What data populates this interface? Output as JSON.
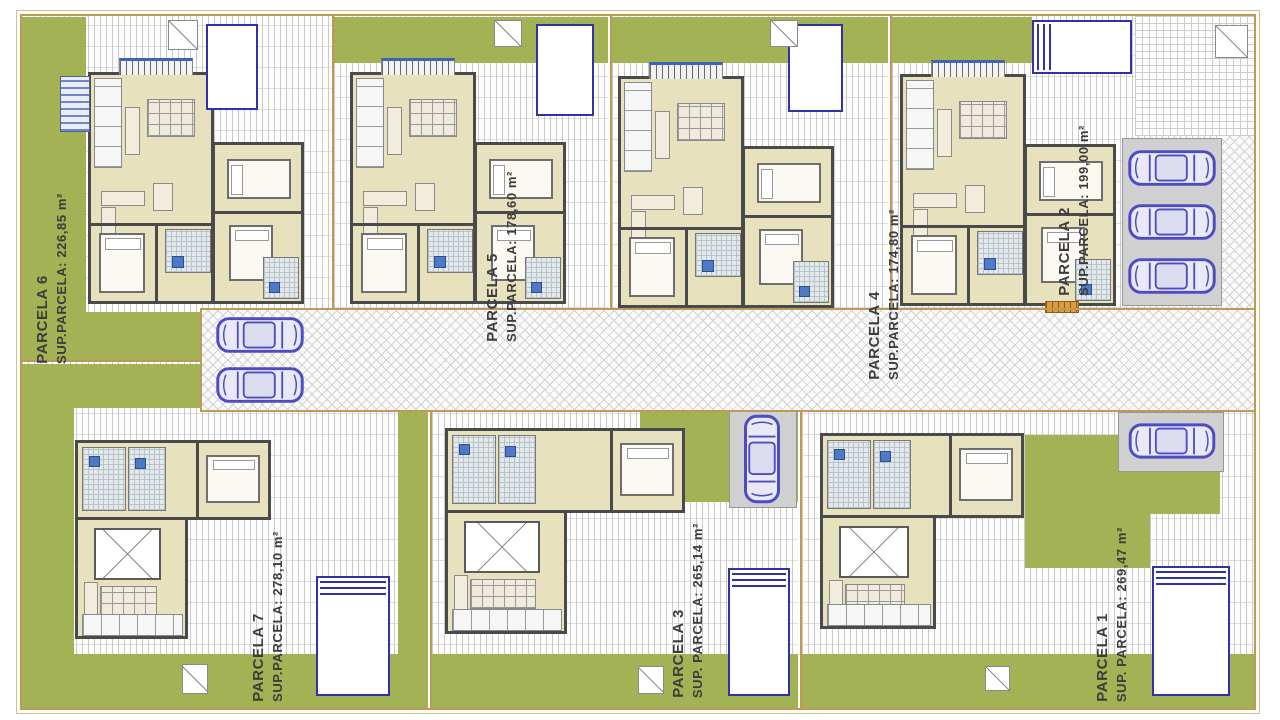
{
  "parcels": [
    {
      "id": "parcela-6",
      "name": "PARCELA 6",
      "area_label": "SUP.PARCELA: 226,85 m²"
    },
    {
      "id": "parcela-5",
      "name": "PARCELA 5",
      "area_label": "SUP.PARCELA: 178,60 m²"
    },
    {
      "id": "parcela-4",
      "name": "PARCELA 4",
      "area_label": "SUP.PARCELA: 174,80 m²"
    },
    {
      "id": "parcela-2",
      "name": "PARCELA 2",
      "area_label": "SUP.PARCELA: 199,00 m²"
    },
    {
      "id": "parcela-7",
      "name": "PARCELA 7",
      "area_label": "SUP.PARCELA: 278,10 m²"
    },
    {
      "id": "parcela-3",
      "name": "PARCELA 3",
      "area_label": "SUP. PARCELA: 265,14 m²"
    },
    {
      "id": "parcela-1",
      "name": "PARCELA 1",
      "area_label": "SUP. PARCELA: 269,47 m²"
    }
  ],
  "colors": {
    "garden_green": "#a2b255",
    "interior_beige": "#e8e1bd",
    "wall_gray": "#4a4a4a",
    "boundary_tan": "#bd9a55",
    "pool_blue": "#3232a8",
    "car_blue": "#4d4dc2",
    "parking_pad_gray": "#d0d0d0",
    "bench_orange": "#e09b3d"
  }
}
